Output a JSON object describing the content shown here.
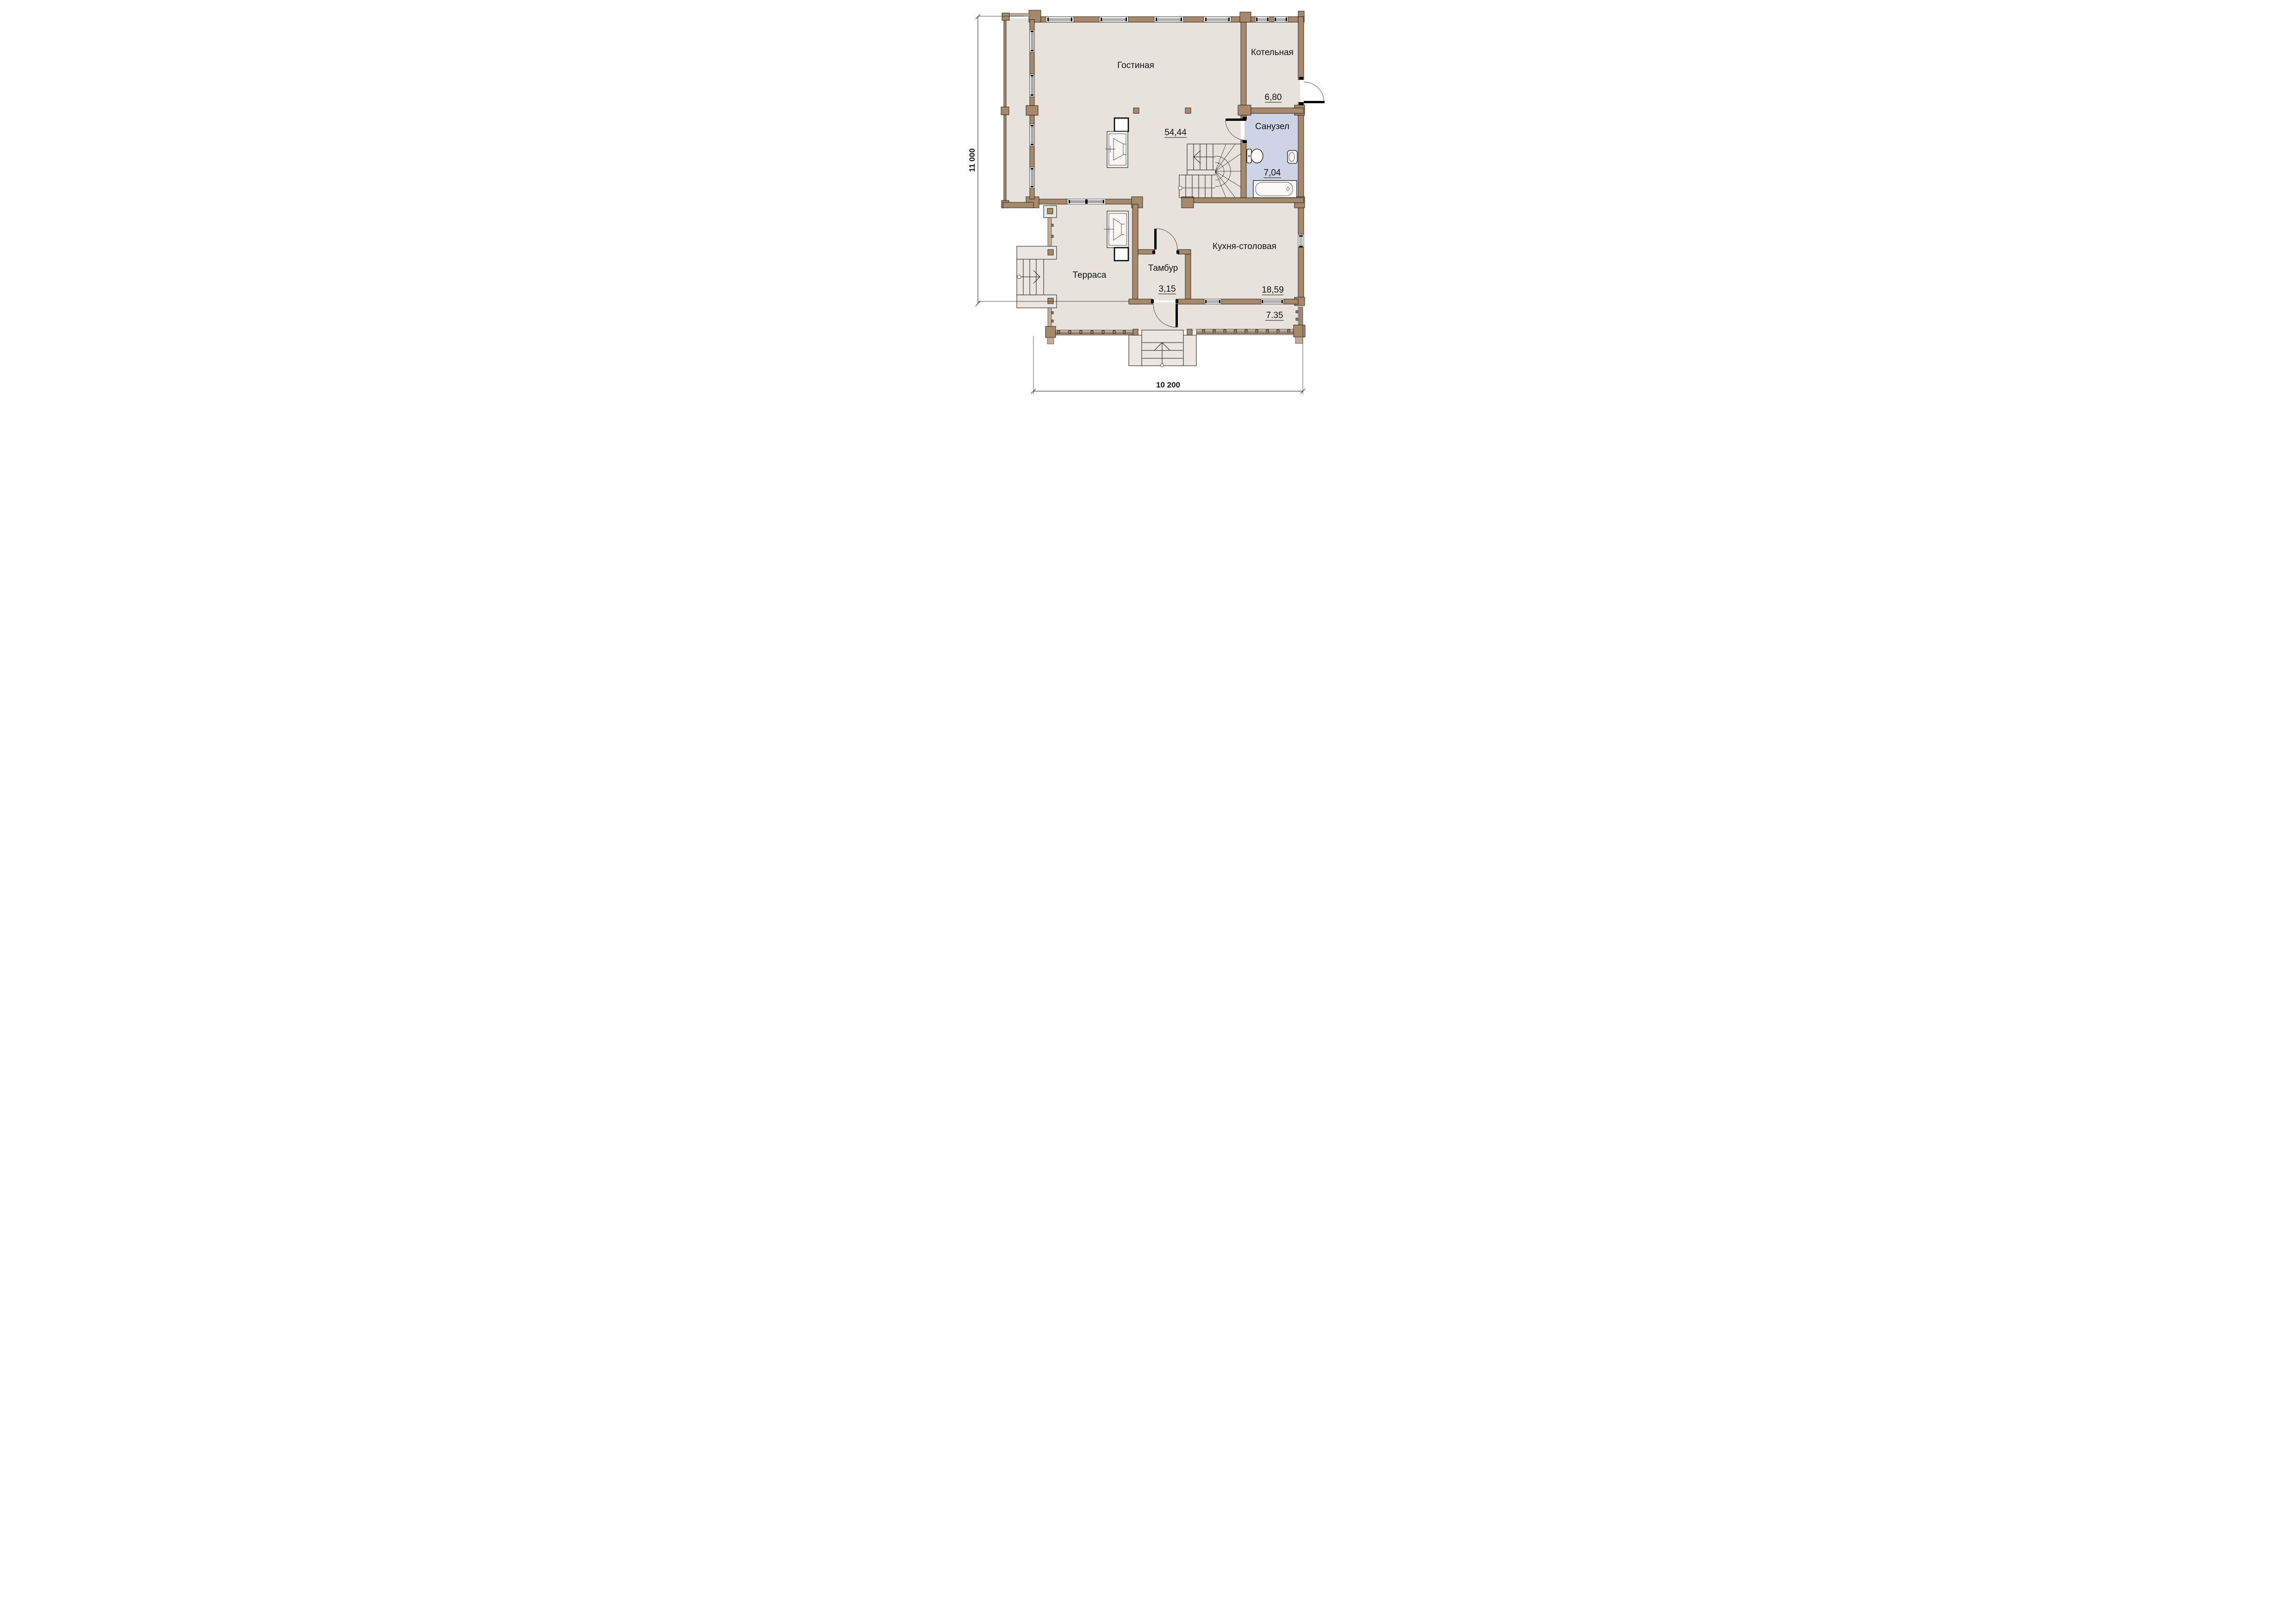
{
  "floor_plan": {
    "rooms": [
      {
        "id": "living",
        "name": "Гостиная",
        "area": "54,44"
      },
      {
        "id": "boiler",
        "name": "Котельная",
        "area": "6,80"
      },
      {
        "id": "bathroom",
        "name": "Санузел",
        "area": "7,04"
      },
      {
        "id": "kitchen",
        "name": "Кухня-столовая",
        "area": "18,59"
      },
      {
        "id": "vestibule",
        "name": "Тамбур",
        "area": "3,15"
      },
      {
        "id": "terrace",
        "name": "Терраса",
        "area": "7.35"
      }
    ],
    "dimensions": {
      "overall_height_mm": "11 000",
      "overall_width_mm": "10 200"
    },
    "colors": {
      "wall": "#A6896A",
      "railing": "#C2AC95",
      "room_fill": "#E8E2DC",
      "bathroom_fill": "#CED4E6",
      "steps_fill": "#EBE6E1",
      "line": "#111111",
      "background": "#FFFFFF"
    }
  }
}
